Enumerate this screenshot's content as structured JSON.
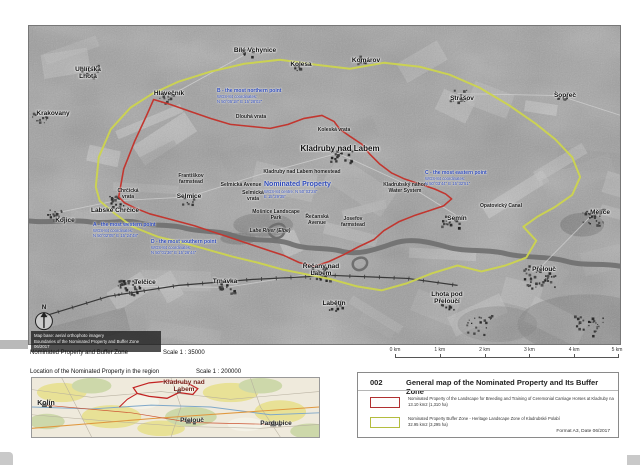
{
  "page": {
    "captions": {
      "main_label": "Nominated Property and Buffer Zone",
      "main_scale": "Scale 1 : 35000",
      "inset_label": "Location of the Nominated Property in the region",
      "inset_scale": "Scale 1 : 200000"
    },
    "scalebar_labels": [
      "0 km",
      "1 km",
      "2 km",
      "3 km",
      "4 km",
      "5 km"
    ],
    "titleblock": {
      "number": "002",
      "title": "General map of the Nominated Property and Its Buffer Zone",
      "legend": [
        {
          "name": "Nominated Property of the Landscape for Breeding and Training of Ceremonial Carriage Horses at Kladruby nad Labem",
          "area": "13.10 km2 (1,310 ha)",
          "swatch_color": "#b03030"
        },
        {
          "name": "Nominated Property Buffer Zone - Heritage Landscape Zone of Kladrubské Polabí",
          "area": "32.95 km2 (3,295 ha)",
          "swatch_color": "#b3bc3e"
        }
      ],
      "footer": "Format A3, Date 06/2017"
    },
    "colors": {
      "property_boundary": "#c2362f",
      "buffer_boundary": "#ccd44e",
      "annotation_blue": "#2b47b8"
    }
  },
  "map": {
    "compass": "N",
    "towns": [
      "Uhlířská Lhota",
      "Krakovany",
      "Hlavečník",
      "Bílé Vchynice",
      "Kolesa",
      "Komárov",
      "Strašov",
      "Sopřeč",
      "Kladruby nad Labem",
      "Labské Chrčice",
      "Kojice",
      "Selmice",
      "Semín",
      "Mělice",
      "Přelouč",
      "Lhota pod Přeloučí",
      "Telčice",
      "Trnávka",
      "Řečany nad Labem",
      "Labětín"
    ],
    "features": [
      "Kladruby nad Labem homestead",
      "Františkov farmstead",
      "Selmická Avenue",
      "Selmická vrata",
      "Koleská vrata",
      "Chrčická vrata",
      "Dlouhá vrata",
      "Mošnice Landscape Park",
      "Labe River (Elbe)",
      "Řečanská Avenue",
      "Josefov farmstead",
      "Kladrubský náhon Water System",
      "Opatovický Canal"
    ],
    "annotations": {
      "west": {
        "heading": "A - the most western point",
        "line1": "WGS-84 coordinates:",
        "line2": "N 50°02'05\"  E 15°24'48\""
      },
      "north": {
        "heading": "B - the most northern point",
        "line1": "WGS-84 coordinates:",
        "line2": "N 50°05'18\"  E 15°28'02\""
      },
      "east": {
        "heading": "C - the most eastern point",
        "line1": "WGS-84 coordinates:",
        "line2": "N 50°03'44\"  E 15°32'51\""
      },
      "south": {
        "heading": "D - the most southern point",
        "line1": "WGS-84 coordinates:",
        "line2": "N 50°01'36\"  E 15°26'44\""
      },
      "center": {
        "heading": "Nominated Property",
        "line1": "WGS-84 centre: N 50°03'28\"",
        "line2": "E 15°29'35\""
      }
    },
    "credits": [
      "Map base: aerial orthophoto imagery",
      "Boundaries of the Nominated Property and Buffer Zone",
      "06/2017"
    ]
  },
  "inset": {
    "towns": [
      "Kolín",
      "Kladruby nad Labem",
      "Přelouč",
      "Pardubice"
    ]
  }
}
